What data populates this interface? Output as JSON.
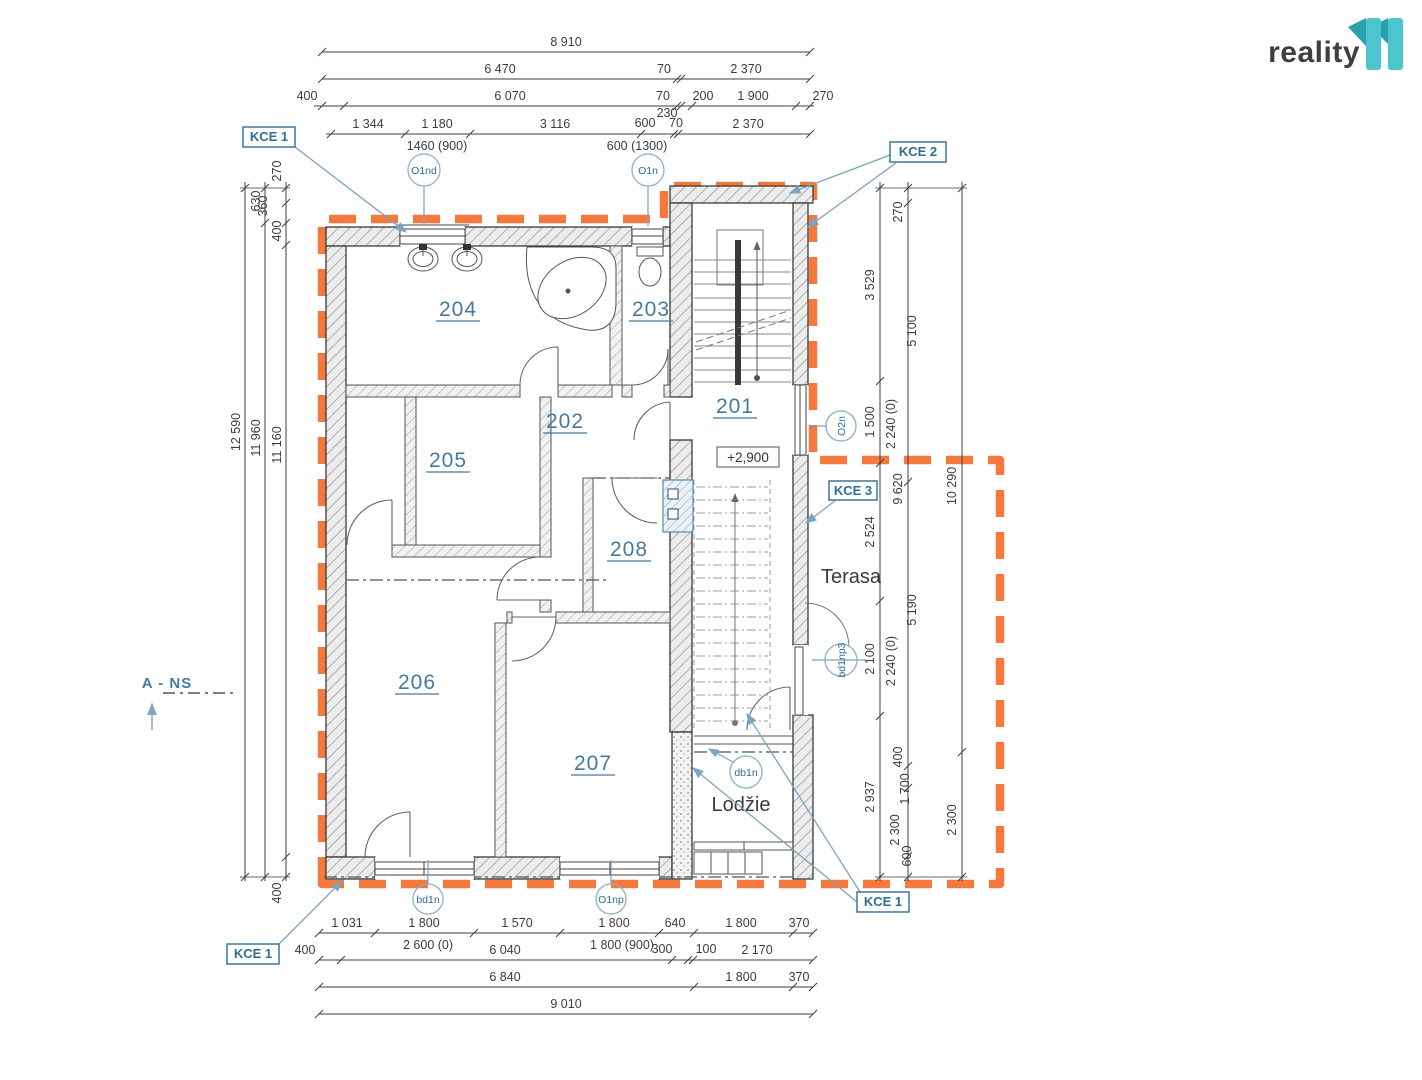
{
  "logo": {
    "brand": "reality",
    "mark": "11"
  },
  "rooms": {
    "r201": "201",
    "r202": "202",
    "r203": "203",
    "r204": "204",
    "r205": "205",
    "r206": "206",
    "r207": "207",
    "r208": "208"
  },
  "areas": {
    "terasa": "Terasa",
    "lodzie": "Lodžie",
    "level": "+2,900",
    "section": "A - NS"
  },
  "kce": {
    "top_left": "KCE 1",
    "top_right": "KCE 2",
    "mid_right": "KCE 3",
    "bottom_right": "KCE 1",
    "bottom_left": "KCE 1"
  },
  "openings": {
    "o1nd": "O1nd",
    "o1n": "O1n",
    "o2n": "O2n",
    "bd1np3": "bd1np3",
    "db1n": "db1n",
    "bd1n": "bd1n",
    "o1np": "O1np"
  },
  "dims": {
    "top1": [
      "8 910"
    ],
    "top2": [
      "6 470",
      "70",
      "2 370"
    ],
    "top3": [
      "400",
      "6 070",
      "70",
      "200",
      "1 900",
      "270"
    ],
    "top3_sub": [
      "230"
    ],
    "top4": [
      "1 344",
      "1 180",
      "3 116",
      "600",
      "70",
      "2 370"
    ],
    "top4_sub": [
      "1460 (900)",
      "600 (1300)"
    ],
    "bottom1": [
      "1 031",
      "1 800",
      "1 570",
      "1 800",
      "640",
      "1 800",
      "370"
    ],
    "bottom1_sub": [
      "2 600 (0)",
      "1 800 (900)"
    ],
    "bottom2": [
      "400",
      "6 040",
      "300",
      "100",
      "2 170"
    ],
    "bottom3": [
      "6 840",
      "1 800",
      "370"
    ],
    "bottom4": [
      "9 010"
    ],
    "left_outer": [
      "12 590"
    ],
    "left_mid": [
      "630",
      "11 960"
    ],
    "left_inner": [
      "270",
      "360",
      "400",
      "11 160",
      "400"
    ],
    "right_inner": [
      "3 529",
      "1 500",
      "2 524",
      "2 100",
      "2 937"
    ],
    "right_openings": [
      "2 240 (0)",
      "2 240 (0)"
    ],
    "right_mid": [
      "270",
      "5 100",
      "9 620",
      "5 190",
      "400",
      "1 700",
      "2 300",
      "600"
    ],
    "right_outer": [
      "10 290",
      "2 300"
    ]
  },
  "colors": {
    "boundary_orange": "#f5793c",
    "annotation_blue": "#2d6e96",
    "leader_blue": "#7aa5c0",
    "room_blue": "#4679a0",
    "line_dark": "#3f3f3f",
    "logo_teal": "#4cc5ce",
    "logo_teal_dark": "#2b9fae"
  }
}
